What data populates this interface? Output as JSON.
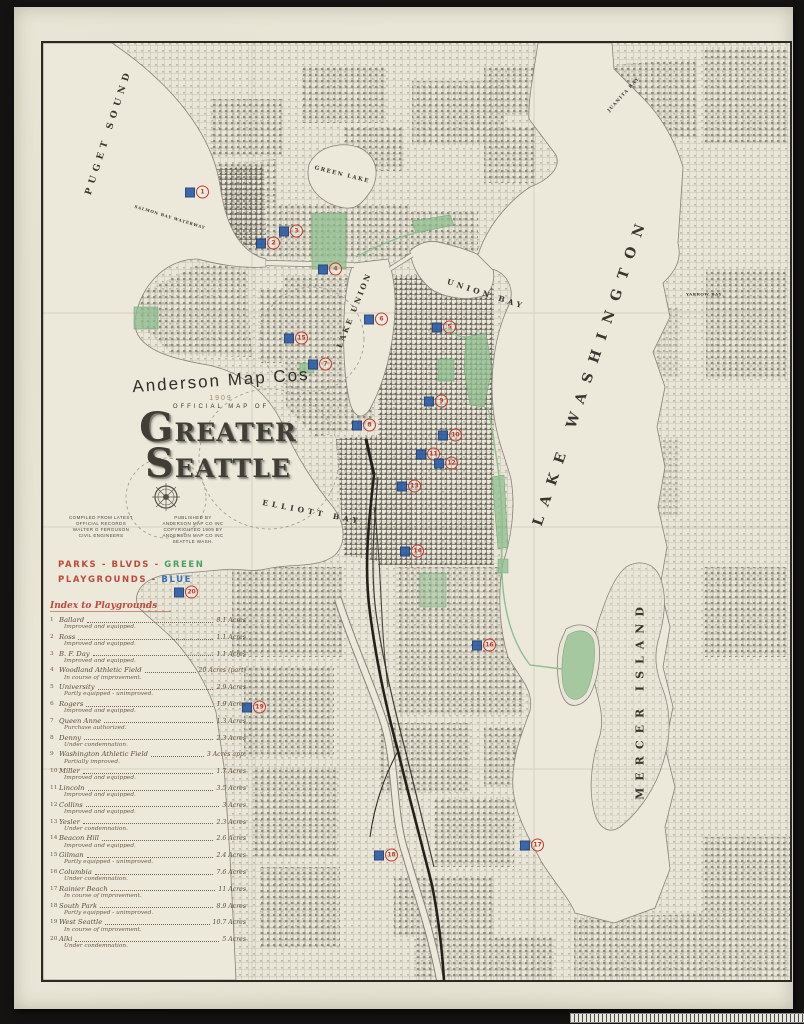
{
  "title_block": {
    "publisher_arc": "Anderson Map Cos",
    "year": "1909",
    "subtitle": "OFFICIAL MAP OF",
    "title_parts": {
      "g": "G",
      "reater": "REATER",
      "s": "S",
      "eattle": "EATTLE"
    }
  },
  "credits": {
    "left": [
      "COMPILED FROM LATEST",
      "OFFICIAL RECORDS",
      "WALTER G FERGUSON",
      "CIVIL ENGINEERS"
    ],
    "right": [
      "PUBLISHED BY",
      "ANDERSON MAP CO INC",
      "COPYRIGHTED 1909 BY",
      "ANDERSON MAP CO INC",
      "SEATTLE WASH."
    ]
  },
  "legend": {
    "line1_label": "PARKS - BLVDS -",
    "line1_value": "GREEN",
    "line2_label": "PLAYGROUNDS -",
    "line2_value": "BLUE",
    "green_hex": "#4d9e62",
    "blue_hex": "#3a6fb5",
    "red_hex": "#bf4a3a"
  },
  "index": {
    "heading": "Index to Playgrounds",
    "items": [
      {
        "num": "1",
        "name": "Ballard",
        "acres": "8.1 Acres",
        "status": "Improved and equipped."
      },
      {
        "num": "2",
        "name": "Ross",
        "acres": "1.1 Acres",
        "status": "Improved and equipped."
      },
      {
        "num": "3",
        "name": "B. F. Day",
        "acres": "1.1 Acres",
        "status": "Improved and equipped."
      },
      {
        "num": "4",
        "name": "Woodland Athletic Field",
        "acres": "20 Acres (part)",
        "status": "In course of improvement."
      },
      {
        "num": "5",
        "name": "University",
        "acres": "2.9 Acres",
        "status": "Partly equipped - unimproved."
      },
      {
        "num": "6",
        "name": "Rogers",
        "acres": "1.9 Acres",
        "status": "Improved and equipped."
      },
      {
        "num": "7",
        "name": "Queen Anne",
        "acres": "1.3 Acres",
        "status": "Purchase authorized."
      },
      {
        "num": "8",
        "name": "Denny",
        "acres": "2.3 Acres",
        "status": "Under condemnation."
      },
      {
        "num": "9",
        "name": "Washington Athletic Field",
        "acres": "3 Acres app.",
        "status": "Partially improved."
      },
      {
        "num": "10",
        "name": "Miller",
        "acres": "1.7 Acres",
        "status": "Improved and equipped."
      },
      {
        "num": "11",
        "name": "Lincoln",
        "acres": "3.5 Acres",
        "status": "Improved and equipped."
      },
      {
        "num": "12",
        "name": "Collins",
        "acres": "3 Acres",
        "status": "Improved and equipped."
      },
      {
        "num": "13",
        "name": "Yesler",
        "acres": "2.3 Acres",
        "status": "Under condemnation."
      },
      {
        "num": "14",
        "name": "Beacon Hill",
        "acres": "2.6 Acres",
        "status": "Improved and equipped."
      },
      {
        "num": "15",
        "name": "Gilman",
        "acres": "2.4 Acres",
        "status": "Partly equipped - unimproved."
      },
      {
        "num": "16",
        "name": "Columbia",
        "acres": "7.6 Acres",
        "status": "Under condemnation."
      },
      {
        "num": "17",
        "name": "Rainier Beach",
        "acres": "11 Acres",
        "status": "In course of improvement."
      },
      {
        "num": "18",
        "name": "South Park",
        "acres": "8.9 Acres",
        "status": "Partly equipped - unimproved."
      },
      {
        "num": "19",
        "name": "West Seattle",
        "acres": "10.7 Acres",
        "status": "In course of improvement."
      },
      {
        "num": "20",
        "name": "Alki",
        "acres": "5 Acres",
        "status": "Under condemnation."
      }
    ]
  },
  "map": {
    "labels": [
      {
        "text": "PUGET SOUND",
        "cx": 95,
        "cy": 125,
        "rot": -72,
        "fs": 9,
        "ls": 5
      },
      {
        "text": "GREEN LAKE",
        "cx": 328,
        "cy": 168,
        "rot": 14,
        "fs": 5.5,
        "ls": 1.5
      },
      {
        "text": "LAKE UNION",
        "cx": 340,
        "cy": 303,
        "rot": -68,
        "fs": 7.5,
        "ls": 2.5
      },
      {
        "text": "UNION BAY",
        "cx": 472,
        "cy": 287,
        "rot": 18,
        "fs": 7.5,
        "ls": 3.5
      },
      {
        "text": "LAKE WASHINGTON",
        "cx": 577,
        "cy": 363,
        "rot": -71,
        "fs": 14,
        "ls": 11
      },
      {
        "text": "ELLIOTT BAY",
        "cx": 298,
        "cy": 505,
        "rot": 11,
        "fs": 7.5,
        "ls": 4
      },
      {
        "text": "MERCER ISLAND",
        "cx": 626,
        "cy": 693,
        "rot": -90,
        "fs": 11,
        "ls": 7
      },
      {
        "text": "JUANITA BAY",
        "cx": 610,
        "cy": 88,
        "rot": -48,
        "fs": 4.5,
        "ls": 1
      },
      {
        "text": "YARROW BAY",
        "cx": 690,
        "cy": 287,
        "rot": 0,
        "fs": 4,
        "ls": 0.5
      },
      {
        "text": "SALMON BAY WATERWAY",
        "cx": 156,
        "cy": 210,
        "rot": 17,
        "fs": 4,
        "ls": 0.8
      }
    ],
    "markers": [
      {
        "num": "1",
        "x": 183,
        "y": 185
      },
      {
        "num": "2",
        "x": 254,
        "y": 236
      },
      {
        "num": "3",
        "x": 277,
        "y": 224
      },
      {
        "num": "4",
        "x": 316,
        "y": 262
      },
      {
        "num": "5",
        "x": 430,
        "y": 320
      },
      {
        "num": "6",
        "x": 362,
        "y": 312
      },
      {
        "num": "7",
        "x": 306,
        "y": 357
      },
      {
        "num": "8",
        "x": 350,
        "y": 418
      },
      {
        "num": "9",
        "x": 422,
        "y": 394
      },
      {
        "num": "10",
        "x": 436,
        "y": 428
      },
      {
        "num": "11",
        "x": 414,
        "y": 447
      },
      {
        "num": "12",
        "x": 432,
        "y": 456
      },
      {
        "num": "13",
        "x": 395,
        "y": 479
      },
      {
        "num": "14",
        "x": 398,
        "y": 544
      },
      {
        "num": "15",
        "x": 282,
        "y": 331
      },
      {
        "num": "16",
        "x": 470,
        "y": 638
      },
      {
        "num": "17",
        "x": 518,
        "y": 838
      },
      {
        "num": "18",
        "x": 372,
        "y": 848
      },
      {
        "num": "19",
        "x": 240,
        "y": 700
      },
      {
        "num": "20",
        "x": 172,
        "y": 585
      }
    ],
    "marker_blue_hex": "#2e5da6",
    "marker_red_hex": "#c23b2e",
    "park_green_hex": "#8fbe8f"
  }
}
